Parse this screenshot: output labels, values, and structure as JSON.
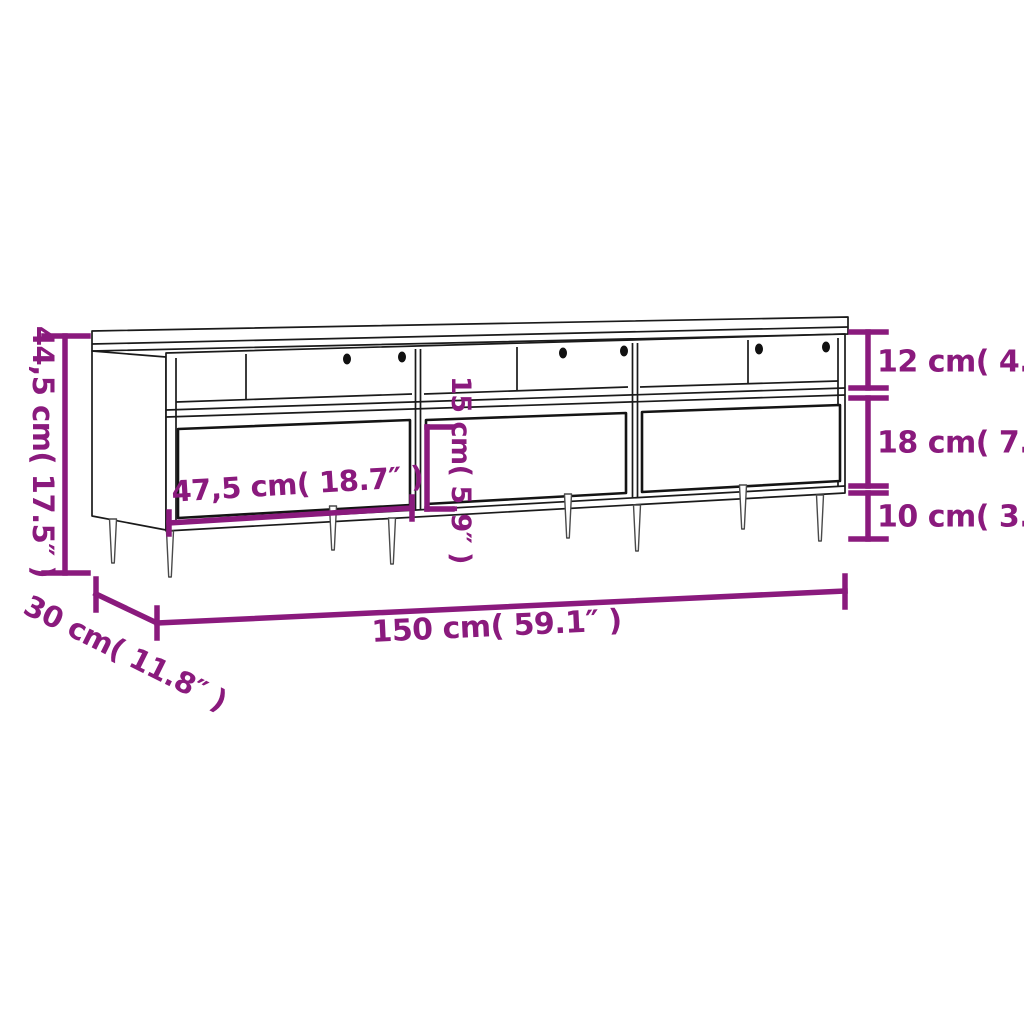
{
  "figure": {
    "title": "TV cabinet dimension diagram",
    "background": "#ffffff",
    "accent_color": "#8A1A7D",
    "outline_color": "#1a1a1a",
    "product": "TV cabinet with 3 open compartments, 3 drawers and tapered legs"
  },
  "labels": {
    "overall_height": "44,5 cm( 17.5″ )",
    "compartment_height": "12 cm( 4.7″ )",
    "drawer_section_height": "18 cm( 7.1″ )",
    "leg_height": "10 cm( 3.9″ )",
    "drawer_front_height": "15 cm( 5.9″ )",
    "drawer_width": "47,5 cm( 18.7″ )",
    "overall_width": "150 cm( 59.1″ )",
    "overall_depth": "30 cm( 11.8″ )"
  }
}
